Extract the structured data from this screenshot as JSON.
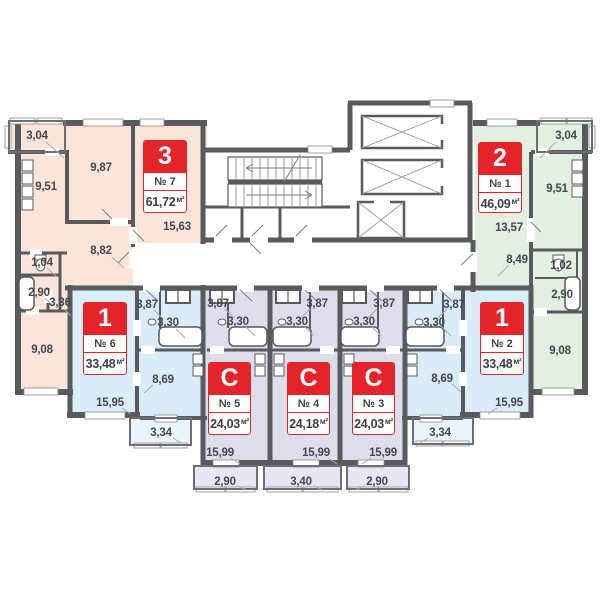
{
  "units": {
    "sqm": "м²"
  },
  "colors": {
    "wall": "#595a5e",
    "apt_3room_fill": "#fbe5db",
    "apt_2room_fill": "#e3efe0",
    "apt_1room_fill": "#d9ecf7",
    "apt_studio_fill": "#dcdeeb",
    "balcony_blue_fill": "#e9f4fb",
    "balcony_studio_fill": "#e6e7f3",
    "badge_red": "#e3242b",
    "label_text": "#45464e"
  },
  "apartments": {
    "apt7": {
      "type": "3",
      "number": "№ 7",
      "area": "61,72",
      "rooms": {
        "balcony": "3,04",
        "room1": "9,87",
        "kitchen": "9,51",
        "living": "15,63",
        "hall": "8,82",
        "wc": "1,04",
        "bath": "2,90",
        "hall2": "3,36",
        "room2": "9,08"
      }
    },
    "apt1": {
      "type": "2",
      "number": "№ 1",
      "area": "46,09",
      "rooms": {
        "balcony": "3,04",
        "kitchen": "9,51",
        "living": "13,57",
        "hall": "8,49",
        "wc": "1,02",
        "bath": "2,90",
        "room": "9,08"
      }
    },
    "apt6": {
      "type": "1",
      "number": "№ 6",
      "area": "33,48",
      "rooms": {
        "hall": "3,87",
        "bath": "3,30",
        "kitchen": "8,69",
        "living": "15,95",
        "balcony": "3,34"
      }
    },
    "apt2": {
      "type": "1",
      "number": "№ 2",
      "area": "33,48",
      "rooms": {
        "hall": "3,87",
        "bath": "3,30",
        "kitchen": "8,69",
        "living": "15,95",
        "balcony": "3,34"
      }
    },
    "apt5": {
      "type": "C",
      "number": "№ 5",
      "area": "24,03",
      "rooms": {
        "hall": "3,87",
        "bath": "3,30",
        "living": "15,99",
        "balcony": "2,90"
      }
    },
    "apt4": {
      "type": "C",
      "number": "№ 4",
      "area": "24,18",
      "rooms": {
        "hall": "3,87",
        "bath": "3,30",
        "living": "15,99",
        "balcony": "3,40"
      }
    },
    "apt3": {
      "type": "C",
      "number": "№ 3",
      "area": "24,03",
      "rooms": {
        "hall": "3,87",
        "bath": "3,30",
        "living": "15,99",
        "balcony": "2,90"
      }
    }
  }
}
